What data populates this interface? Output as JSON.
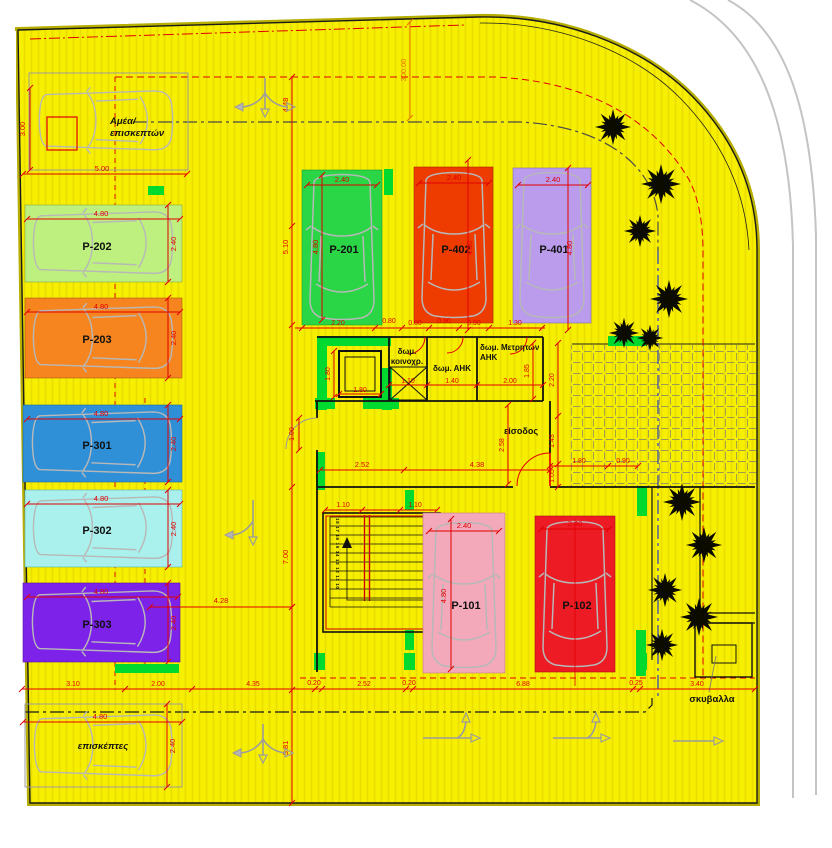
{
  "title": "parking-layout-plan",
  "colors": {
    "plot_yellow": "#f7ef00",
    "dimension_red": "#e10000",
    "pillar_green": "#00d92e",
    "wall_black": "#111111",
    "car_outline": "#b8b8b8"
  },
  "spaces": {
    "amea": {
      "label1": "Αμέα/",
      "label2": "επισκεπτών",
      "width": "5.00",
      "depth": "3.00"
    },
    "p202": {
      "label": "P-202",
      "width": "4.80",
      "depth": "2.40",
      "color": "#bdf07e"
    },
    "p203": {
      "label": "P-203",
      "width": "4.80",
      "depth": "2.40",
      "color": "#f6851f"
    },
    "p301": {
      "label": "P-301",
      "width": "4.80",
      "depth": "2.40",
      "color": "#2f90d8"
    },
    "p302": {
      "label": "P-302",
      "width": "4.80",
      "depth": "2.40",
      "color": "#aaf1ee"
    },
    "p303": {
      "label": "P-303",
      "width": "4.80",
      "depth": "2.40",
      "color": "#7d22e9"
    },
    "p201": {
      "label": "P-201",
      "width": "2.40",
      "height": "4.80",
      "color": "#2ad546"
    },
    "p402": {
      "label": "P-402",
      "width": "2.40",
      "height": "4.80",
      "color": "#ee3b00"
    },
    "p401": {
      "label": "P-401",
      "width": "2.40",
      "height": "4.80",
      "color": "#ba9bec"
    },
    "p101": {
      "label": "P-101",
      "width": "2.40",
      "height": "4.80",
      "color": "#f3a9ba"
    },
    "p102": {
      "label": "P-102",
      "width": "2.40",
      "color": "#ec1b24"
    },
    "visitors": {
      "label": "επισκέπτες",
      "width": "4.80",
      "depth": "2.40"
    }
  },
  "rooms": {
    "elevator": {
      "width": "1.80",
      "depth": "1.80"
    },
    "koinoxr": {
      "label1": "δωμ.",
      "label2": "κοινοχρ.",
      "width": "1.10"
    },
    "ahk": {
      "label": "δωμ. ΑΗΚ",
      "width": "1.40"
    },
    "metriton": {
      "label1": "δωμ. Μετρητών",
      "label2": "ΑΗΚ",
      "width": "2.00",
      "height": "1.85"
    },
    "entrance": {
      "label": "είσοδος"
    },
    "garbage": {
      "label": "σκυβαλλα",
      "width": "3.40"
    }
  },
  "stairs": {
    "left_numbers": "18 17 16 15 14 13 12 11 10",
    "right_numbers": "1 2 3 4 5 6 7 8 9",
    "dim_left": "1.10",
    "dim_right": "1.10"
  },
  "dims": {
    "road_station": "300.00",
    "d448": "4.48",
    "d510": "5.10",
    "d700": "7.00",
    "d428": "4.28",
    "d381": "3.81",
    "d100": "1.00",
    "d252": "2.52",
    "d438": "4.38",
    "d258": "2.58",
    "d220": "2.20",
    "d143": "1.43",
    "d105": "1.05",
    "d180": "1.80",
    "d090": "0.90",
    "mid_row": [
      "2.20",
      "0.80",
      "0.80",
      "0.90",
      "0.90",
      "1.30"
    ],
    "bottom_row": [
      "3.10",
      "2.00",
      "4.35",
      "0.20",
      "2.52",
      "0.20",
      "6.88",
      "0.25",
      "3.40"
    ],
    "garbage_offset": "0.25"
  }
}
